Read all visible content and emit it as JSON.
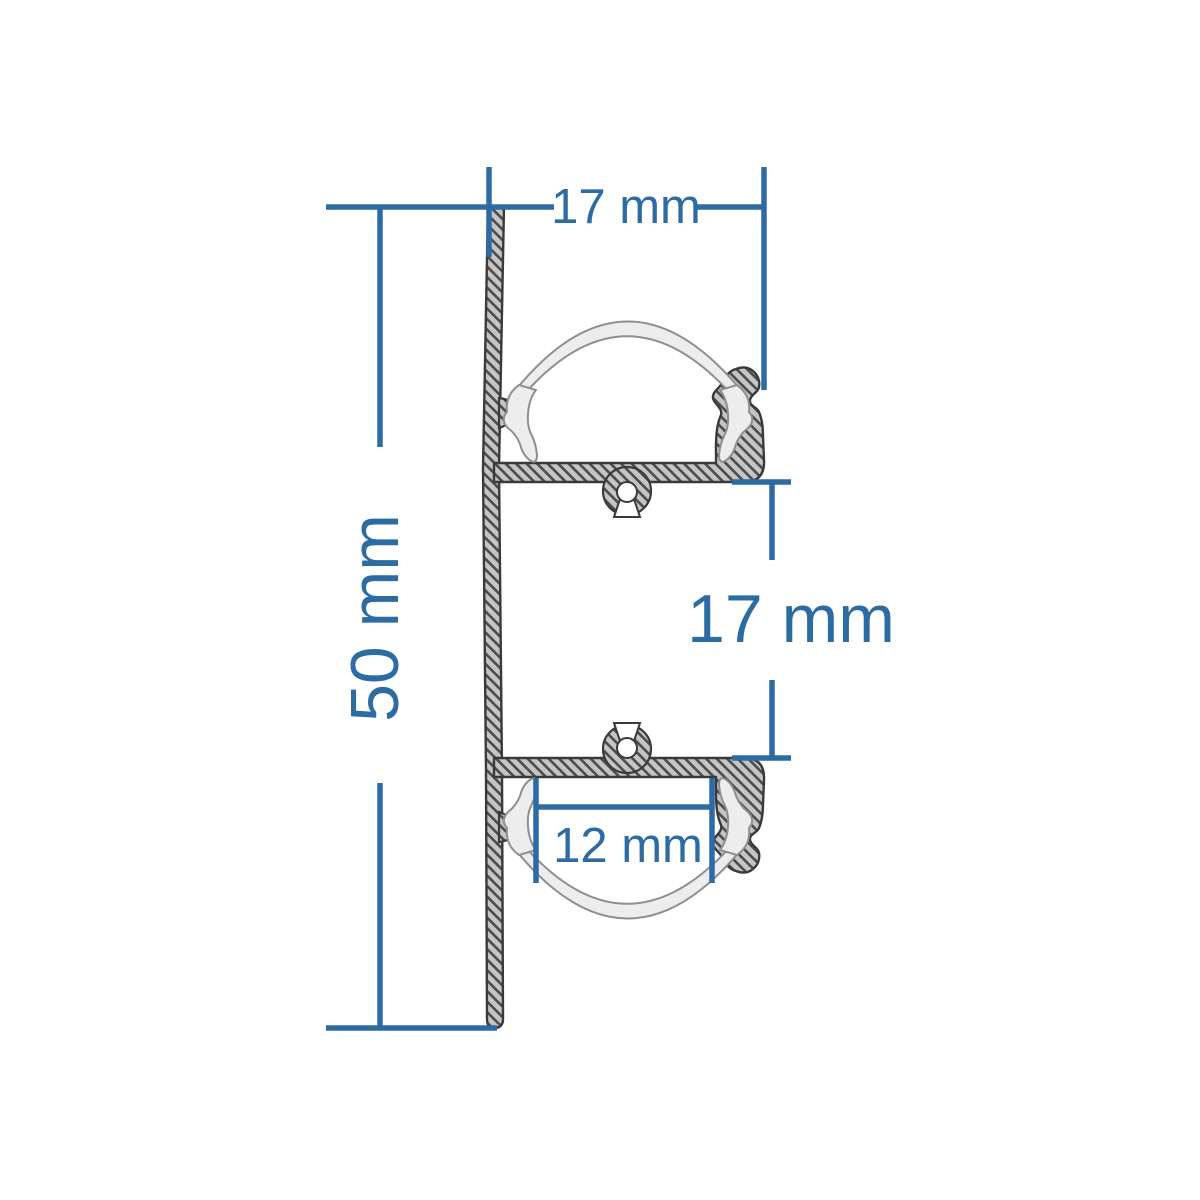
{
  "diagram": {
    "title": "Aluminium LED profile cross-section drawing",
    "type": "technical-drawing",
    "dimensions": {
      "top_width": {
        "value": 17,
        "unit": "mm",
        "label": "17 mm"
      },
      "overall_height": {
        "value": 50,
        "unit": "mm",
        "label": "50 mm"
      },
      "middle_gap": {
        "value": 17,
        "unit": "mm",
        "label": "17 mm"
      },
      "inner_width": {
        "value": 12,
        "unit": "mm",
        "label": "12 mm"
      }
    },
    "colors": {
      "dimension": "#2d6ca3",
      "aluminium_fill": "#c5c5c5",
      "hatch": "#4d4d4d",
      "outline": "#3a3a3a",
      "diffuser_fill": "#ededed",
      "diffuser_outline": "#8f8f8f",
      "background": "#ffffff"
    }
  }
}
